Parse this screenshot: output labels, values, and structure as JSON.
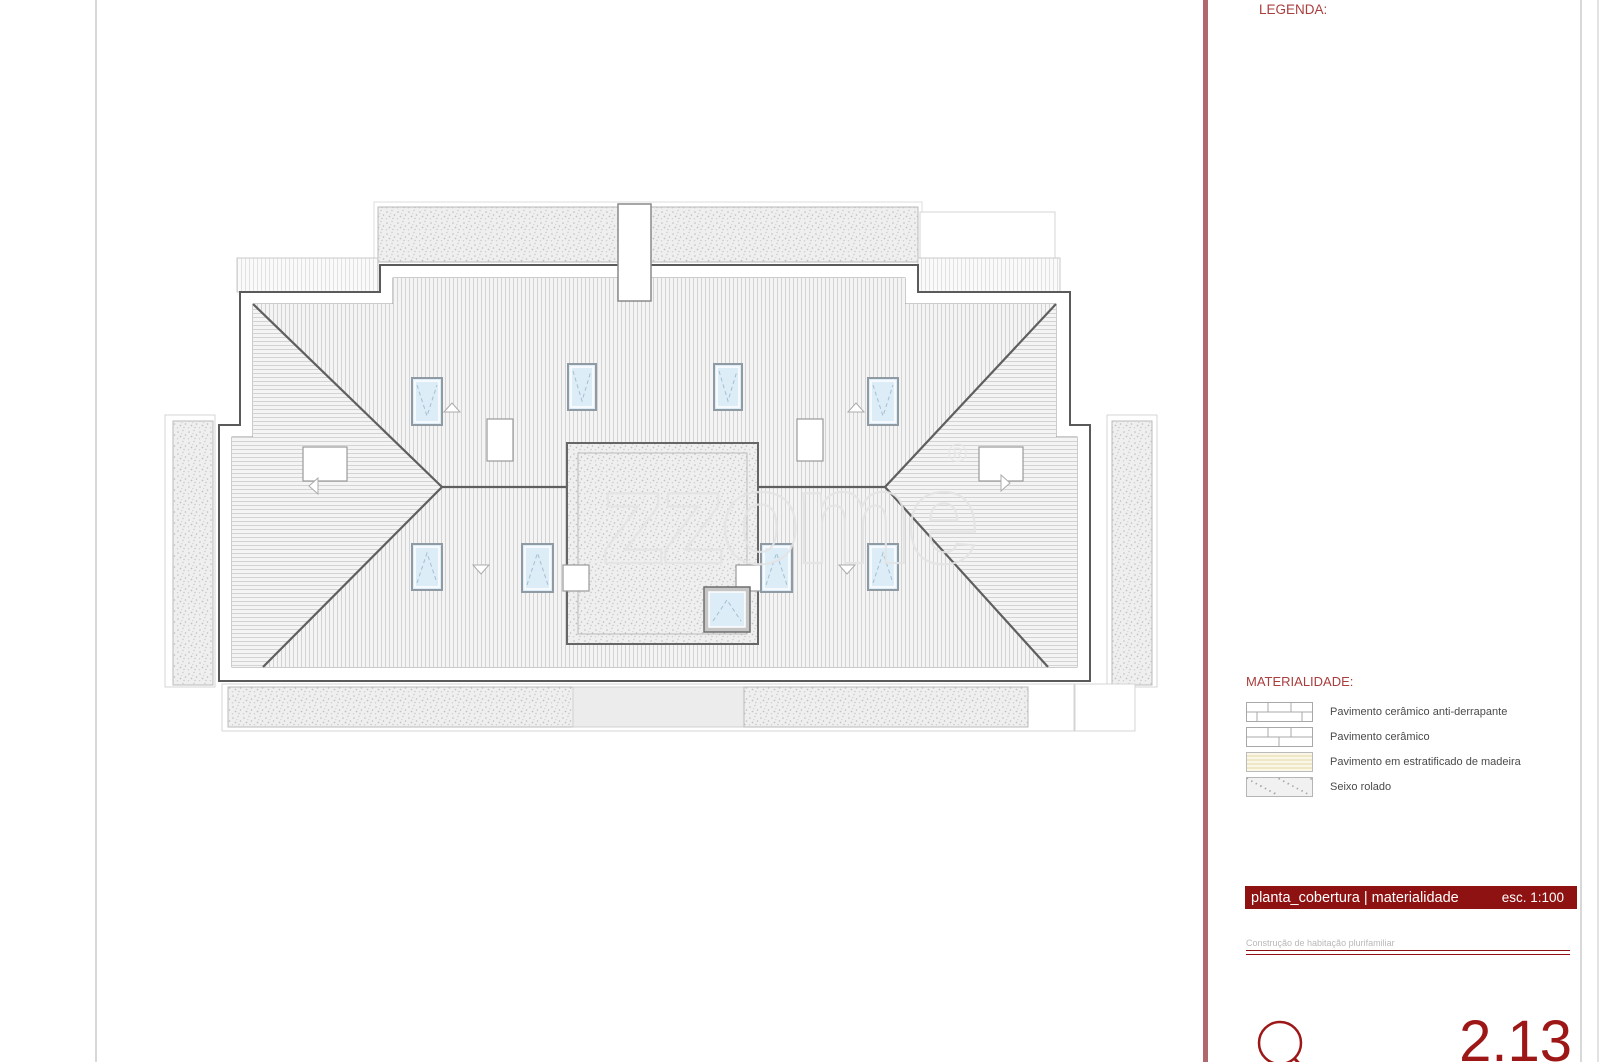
{
  "colors": {
    "accent_band": "#b06a6d",
    "deep_red": "#8e1211",
    "label_red": "#a93e3e",
    "logo_red": "#9e1717",
    "skylight_blue": "#dcedf8"
  },
  "panel": {
    "legend_title": "LEGENDA:",
    "materiality": {
      "title": "MATERIALIDADE:",
      "items": [
        {
          "label": "Pavimento cerâmico anti-derrapante",
          "pattern": "tile-offset"
        },
        {
          "label": "Pavimento cerâmico",
          "pattern": "tile"
        },
        {
          "label": "Pavimento em estratificado de madeira",
          "pattern": "wood-laminate"
        },
        {
          "label": "Seixo rolado",
          "pattern": "stipple"
        }
      ]
    },
    "title_block": {
      "drawing_title": "planta_cobertura | materialidade",
      "scale": "esc. 1:100",
      "project_name": "Construção de habitação plurifamiliar",
      "sheet_number": "2.13"
    }
  },
  "drawing": {
    "watermark": "zzome",
    "watermark_mark": "®",
    "skylights": [
      {
        "x": 412,
        "y": 378,
        "w": 30,
        "h": 47,
        "dir": "down"
      },
      {
        "x": 568,
        "y": 364,
        "w": 28,
        "h": 46,
        "dir": "down"
      },
      {
        "x": 714,
        "y": 364,
        "w": 28,
        "h": 46,
        "dir": "down"
      },
      {
        "x": 868,
        "y": 378,
        "w": 30,
        "h": 47,
        "dir": "down"
      },
      {
        "x": 412,
        "y": 544,
        "w": 30,
        "h": 46,
        "dir": "up"
      },
      {
        "x": 522,
        "y": 544,
        "w": 31,
        "h": 48,
        "dir": "up"
      },
      {
        "x": 761,
        "y": 544,
        "w": 31,
        "h": 48,
        "dir": "up"
      },
      {
        "x": 868,
        "y": 544,
        "w": 30,
        "h": 46,
        "dir": "up"
      }
    ],
    "terrace_skylight": {
      "x": 704,
      "y": 587,
      "w": 46,
      "h": 45,
      "dir": "up"
    },
    "roof_vents": [
      {
        "x": 487,
        "y": 419,
        "w": 26,
        "h": 42
      },
      {
        "x": 797,
        "y": 419,
        "w": 26,
        "h": 42
      },
      {
        "x": 303,
        "y": 447,
        "w": 44,
        "h": 34
      },
      {
        "x": 979,
        "y": 447,
        "w": 44,
        "h": 34
      }
    ],
    "slope_arrows": [
      {
        "x": 452,
        "y": 407,
        "dir": "up"
      },
      {
        "x": 856,
        "y": 407,
        "dir": "up"
      },
      {
        "x": 481,
        "y": 570,
        "dir": "down"
      },
      {
        "x": 847,
        "y": 570,
        "dir": "down"
      },
      {
        "x": 311,
        "y": 486,
        "dir": "left"
      },
      {
        "x": 1008,
        "y": 483,
        "dir": "right"
      }
    ]
  }
}
